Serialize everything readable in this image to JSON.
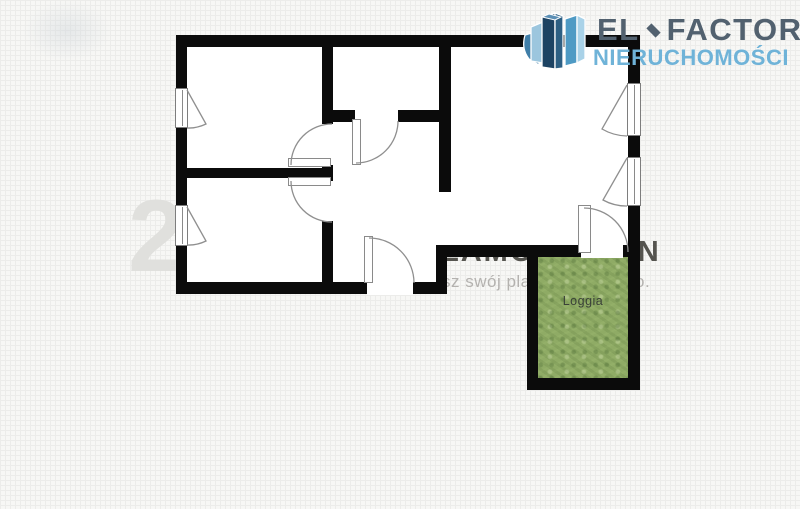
{
  "brand": {
    "name_left": "EL",
    "name_right": "FACTOR",
    "subtitle": "NIERUCHOMOŚCI",
    "icon": "buildings-3d-icon",
    "primary_color": "#52616f",
    "secondary_color": "#6fb3d8"
  },
  "floorplan": {
    "loggia_label": "Loggia",
    "wall_color": "#0b0b0b",
    "loggia_green": "#8fab65",
    "rooms_visible": [
      "room-top-left",
      "room-bottom-left",
      "bathroom",
      "hall",
      "living-room",
      "loggia"
    ]
  },
  "watermark": {
    "text_fragment_left": "sz swój pla",
    "text_fragment_right": "o.",
    "ghost_digit": "2",
    "clipped_word": "ZAMÓW PLAN",
    "color": "#b4b2af"
  }
}
